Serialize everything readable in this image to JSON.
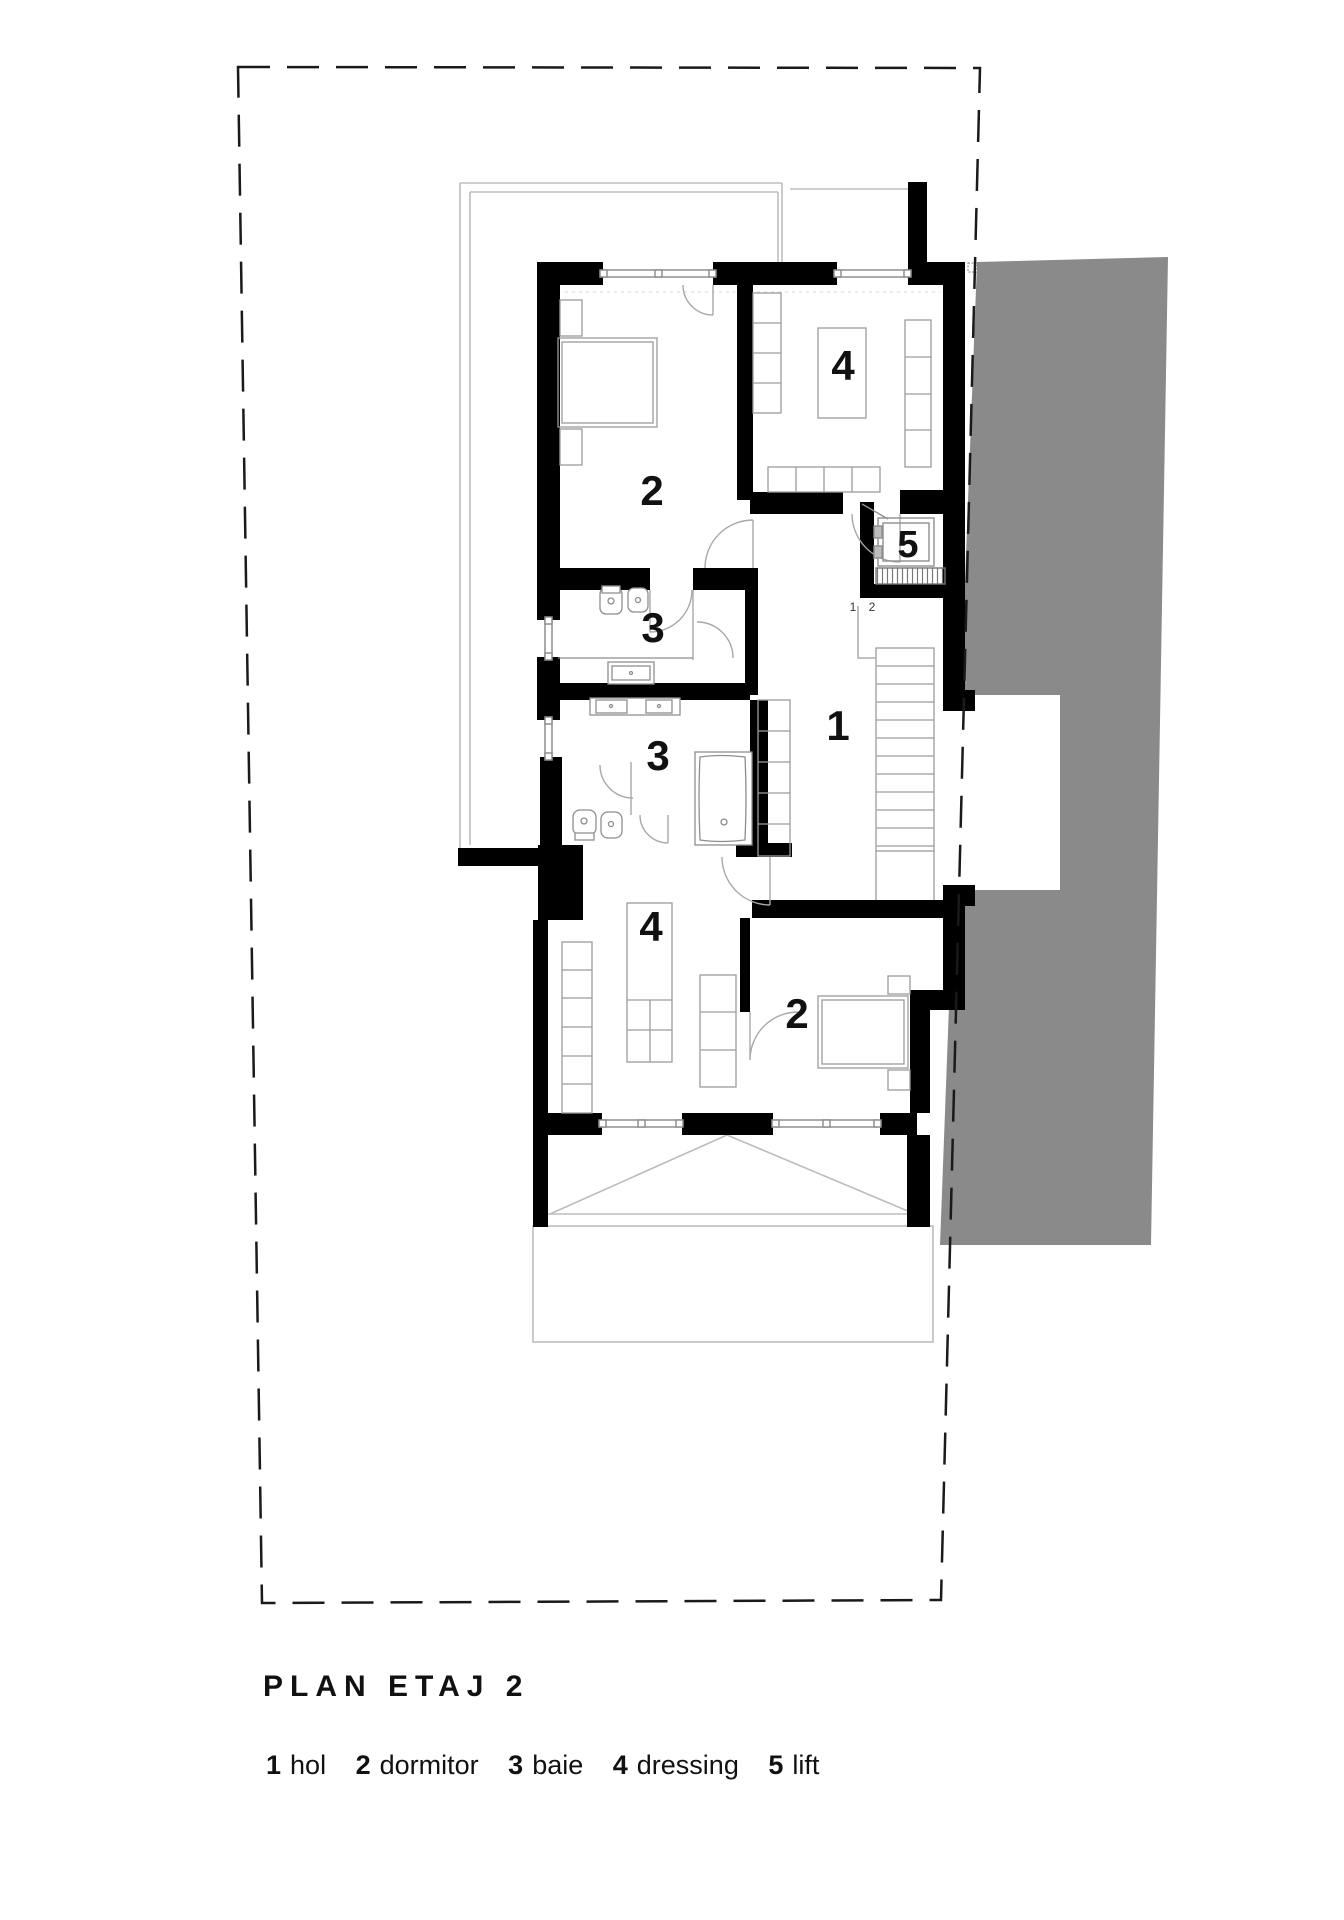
{
  "title": "PLAN ETAJ 2",
  "legend": {
    "items": [
      {
        "num": "1",
        "label": "hol"
      },
      {
        "num": "2",
        "label": "dormitor"
      },
      {
        "num": "3",
        "label": "baie"
      },
      {
        "num": "4",
        "label": "dressing"
      },
      {
        "num": "5",
        "label": "lift"
      }
    ]
  },
  "rooms": {
    "dormitor_top": "2",
    "dressing_top": "4",
    "lift": "5",
    "baie_top": "3",
    "hol": "1",
    "baie_bottom": "3",
    "dressing_bottom": "4",
    "dormitor_bottom": "2"
  },
  "stair_steps": [
    "1",
    "2"
  ],
  "colors": {
    "wall": "#000000",
    "shadow": "#8a8a8a",
    "boundary": "#1a1a1a",
    "furniture": "#9c9c9c",
    "terrace_line": "#bdbdbd",
    "label": "#111111"
  }
}
